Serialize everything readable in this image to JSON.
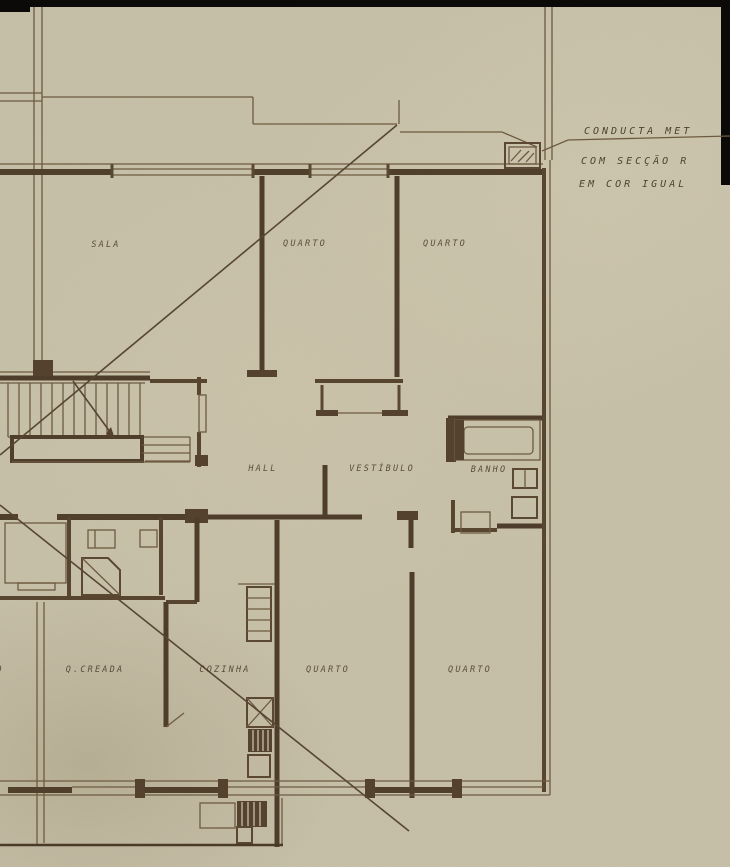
{
  "annotation": {
    "line1": "CONDUCTA MET",
    "line2": "COM SECÇÃO R",
    "line3": "EM COR IGUAL"
  },
  "rooms": {
    "sala": "SALA",
    "quarto_top_left": "QUARTO",
    "quarto_top_right": "QUARTO",
    "hall": "HALL",
    "vestibulo": "VESTÍBULO",
    "banho": "BANHO",
    "q_creada": "Q.CREADA",
    "cozinha": "COZINHA",
    "quarto_bottom_left": "QUARTO",
    "quarto_bottom_right": "QUARTO",
    "partial_left_label": "O"
  },
  "colors": {
    "paper": "#c7c0a8",
    "ink_dark": "#4e3d2a",
    "ink_thin": "#6d5b41",
    "scan_black": "#0b0a08",
    "label_ink": "#483a27"
  }
}
